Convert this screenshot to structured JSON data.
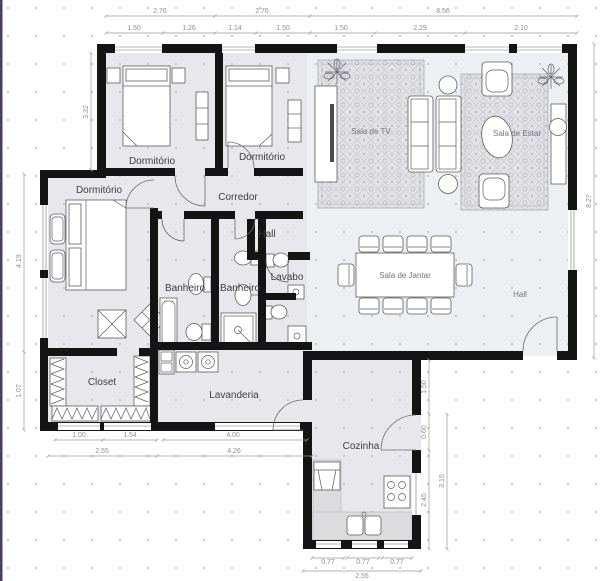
{
  "colors": {
    "wall": "#141414",
    "room": "#e8e8ec",
    "living": "#edeff3",
    "rug": "#e2e2e6",
    "dim_text": "#8f8f95",
    "label_text": "#3c3c42",
    "edge": "#4a3e63"
  },
  "rooms": {
    "dorm1": "Dormitório",
    "dorm2": "Dormitório",
    "dorm3": "Dormitório",
    "corredor": "Corredor",
    "hall": "Hall",
    "lavabo": "Lavabo",
    "banheiro1": "Banheiro",
    "banheiro2": "Banheiro",
    "closet": "Closet",
    "lavanderia": "Lavanderia",
    "cozinha": "Cozinha",
    "sala_tv": "Sala de TV",
    "sala_estar": "Sala de Estar",
    "sala_jantar": "Sala de Jantar",
    "hall2": "Hall"
  },
  "dims": {
    "top_row1": [
      "2.76",
      "2.76",
      "8.56"
    ],
    "top_row2": [
      "1.50",
      "1.26",
      "1.14",
      "1.50",
      "1.50",
      "2.29",
      "2.10"
    ],
    "left": [
      "3.32",
      "4.19",
      "1.07"
    ],
    "right": [
      "8.27"
    ],
    "kitchen_side": [
      "1.50",
      "0.60",
      "2.45",
      "3.15"
    ],
    "bottom_row1": [
      "1.00",
      "1.54",
      "4.00"
    ],
    "bottom_row2": [
      "2.55",
      "4.26"
    ],
    "kitchen_bottom": [
      "0.77",
      "0.77",
      "0.77"
    ],
    "kitchen_bottom_total": "2.55"
  }
}
